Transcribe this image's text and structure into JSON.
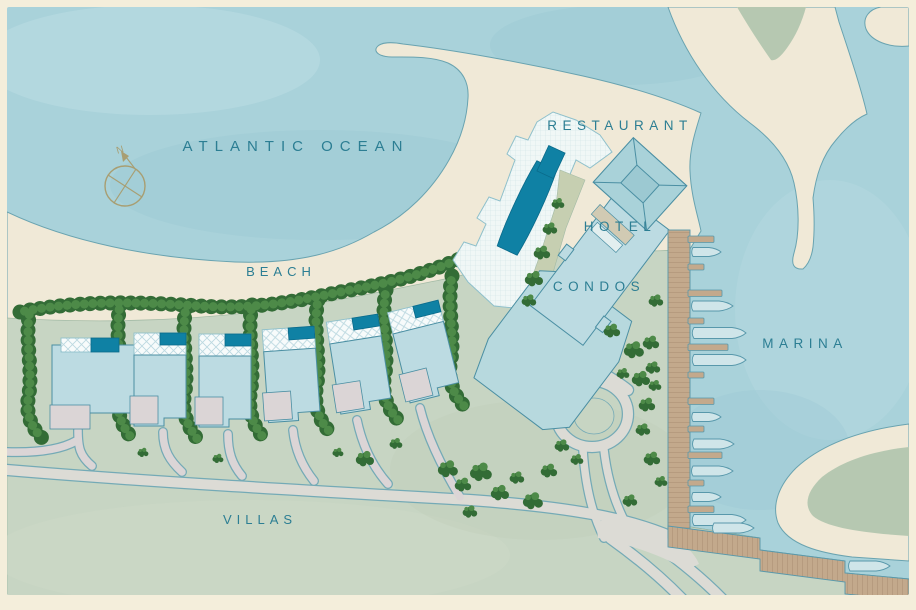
{
  "map": {
    "labels": {
      "ocean": "ATLANTIC OCEAN",
      "beach": "BEACH",
      "restaurant": "RESTAURANT",
      "hotel": "HOTEL",
      "condos": "CONDOS",
      "marina": "MARINA",
      "villas": "VILLAS",
      "compass_north": "N"
    },
    "colors": {
      "border": "#f4eedb",
      "water": "#a9d2da",
      "water_light": "#bcdde3",
      "water_deep": "#9cc9d3",
      "coast": "#69a3b0",
      "sand": "#f0e9d7",
      "land": "#c7d5c3",
      "land_dark": "#b6c8b1",
      "land_edge": "#a3bba6",
      "garden": "#c6cfb1",
      "road": "#dcdbd5",
      "driveway": "#dbd5d6",
      "road_edge": "#74aab6",
      "boardwalk": "#c3a98c",
      "boardwalk_line": "#b09579",
      "pier_edge": "#5898ab",
      "boat": "#cfe5e9",
      "pool": "#0f81a4",
      "pool_edge": "#0a6a8a",
      "building": "#bcdbe2",
      "condos": "#b7d9de",
      "building_edge": "#4b8fa3",
      "roof": "#a9d2d9",
      "roof_inner": "#9cc9d2",
      "deck_edge": "#8fc0cb",
      "tan_strip": "#d1cab3",
      "tree_dark": "#336c36",
      "tree_light": "#4d8a48",
      "label_text": "#2c7e93",
      "compass": "#a89e72"
    }
  }
}
